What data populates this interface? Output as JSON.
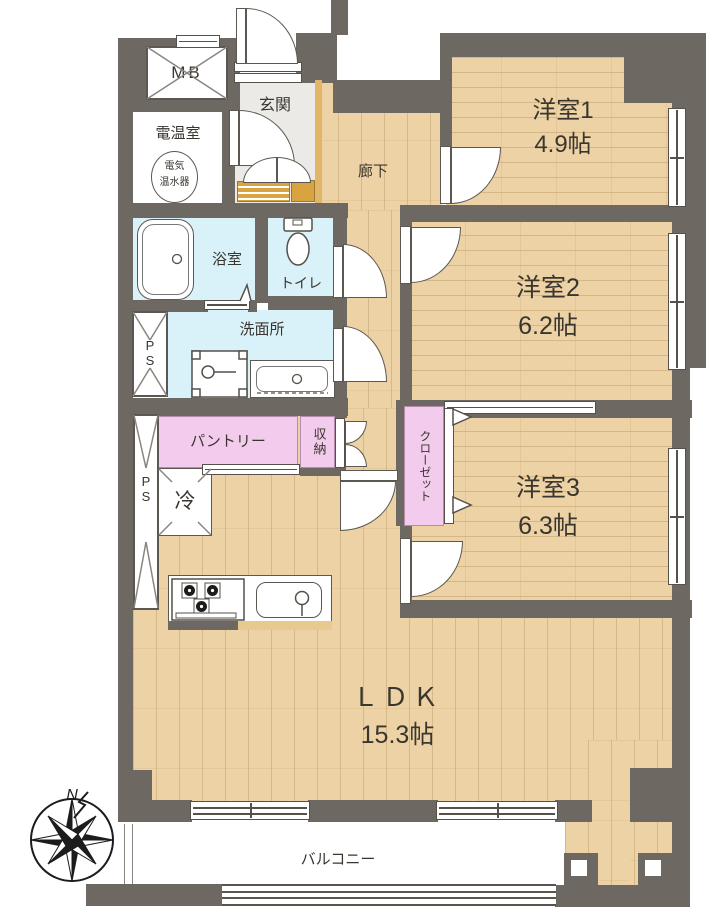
{
  "rooms": {
    "yoshitsu1": {
      "name": "洋室1",
      "size": "4.9帖"
    },
    "yoshitsu2": {
      "name": "洋室2",
      "size": "6.2帖"
    },
    "yoshitsu3": {
      "name": "洋室3",
      "size": "6.3帖"
    },
    "ldk": {
      "name": "ＬＤＫ",
      "size": "15.3帖"
    },
    "genkan": {
      "name": "玄関"
    },
    "rouka": {
      "name": "廊下"
    },
    "yokushitsu": {
      "name": "浴室"
    },
    "toire": {
      "name": "トイレ"
    },
    "senmenjo": {
      "name": "洗面所"
    },
    "pantry": {
      "name": "パントリー"
    },
    "shuno": {
      "name": "収納"
    },
    "closet": {
      "name": "クローゼット"
    },
    "balcony": {
      "name": "バルコニー"
    },
    "dennonshitsu": {
      "name": "電温室"
    },
    "water_heater": {
      "line1": "電気",
      "line2": "温水器"
    },
    "mb": {
      "name": "MB"
    },
    "ps": {
      "name": "P S"
    },
    "reizoko": {
      "name": "冷"
    }
  },
  "compass": {
    "north": "N"
  },
  "colors": {
    "wall": "#6e6862",
    "flooring": "#ecd2a5",
    "wet_area": "#d9f1f8",
    "storage_pink": "#f3cbec",
    "entry_floor": "#eceae7",
    "step_gold": "#d9a33f"
  }
}
